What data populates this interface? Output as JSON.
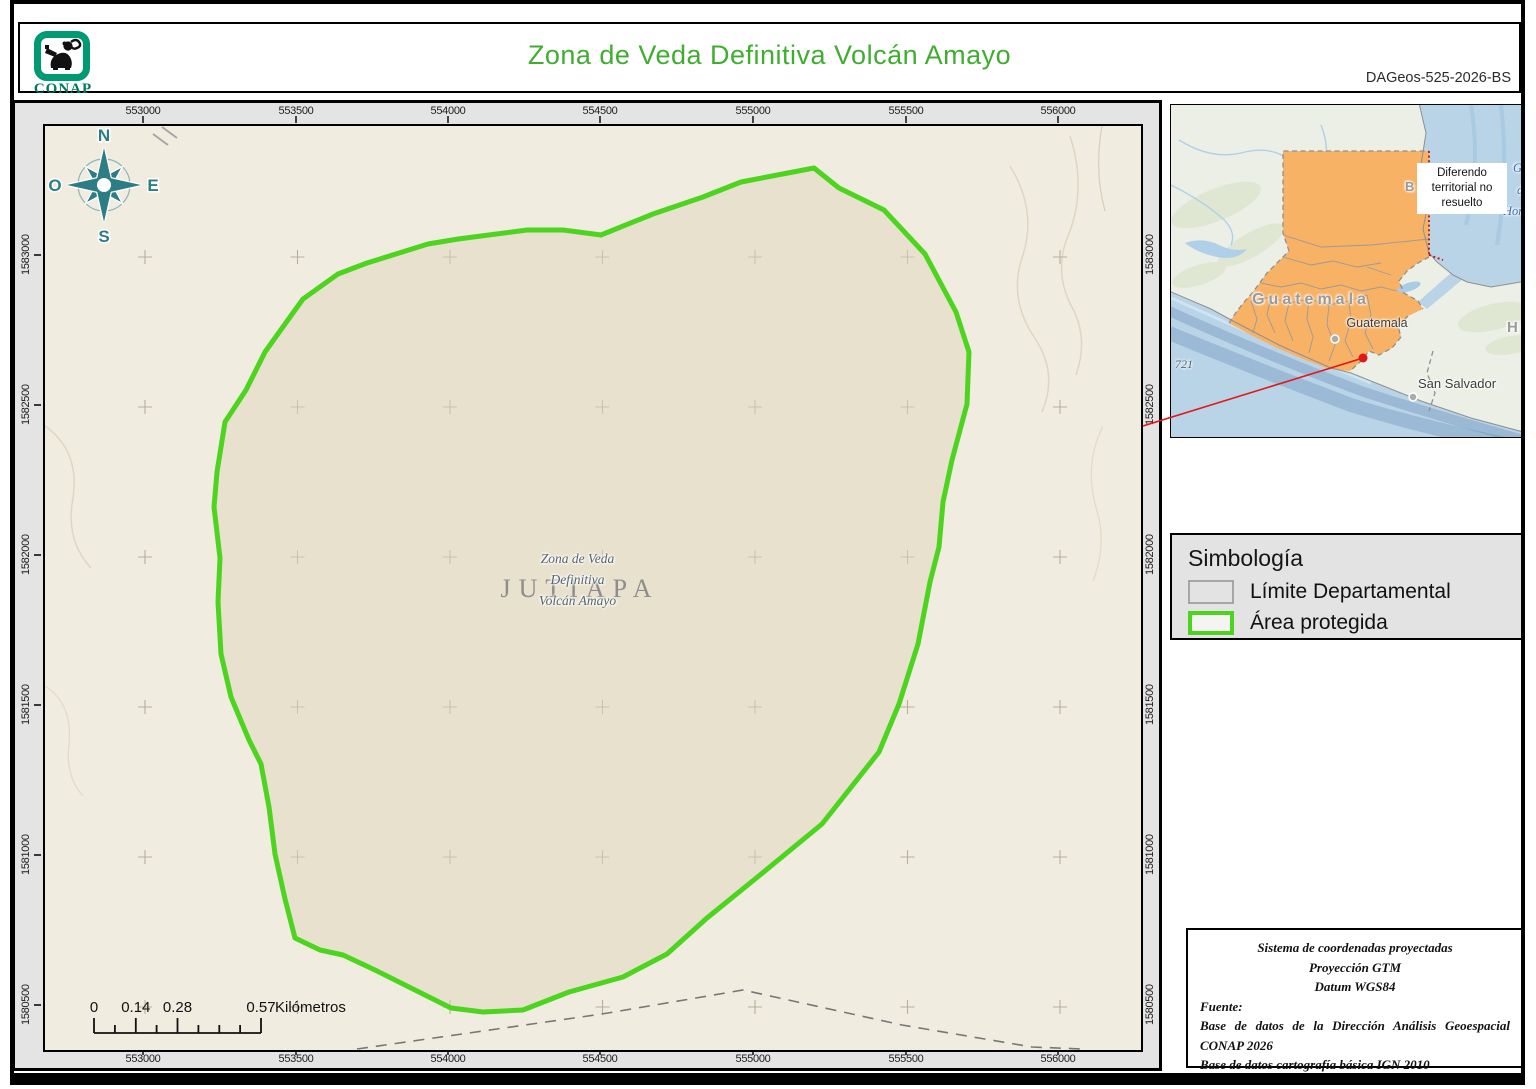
{
  "page": {
    "logo": "CONAP",
    "title": "Zona de Veda Definitiva Volcán Amayo",
    "doc_id": "DAGeos-525-2026-BS"
  },
  "map": {
    "x_ticks": [
      "553000",
      "553500",
      "554000",
      "554500",
      "555000",
      "555500",
      "556000"
    ],
    "y_ticks": [
      "1583000",
      "1582500",
      "1582000",
      "1581500",
      "1581000",
      "1580500"
    ],
    "compass": {
      "n": "N",
      "s": "S",
      "e": "E",
      "o": "O"
    },
    "area_label": {
      "line1": "Zona de Veda",
      "line2": "Definitiva",
      "line3": "Volcán Amayo"
    },
    "department_label": "JUTIAPA",
    "scalebar": {
      "t0": "0",
      "t1": "0.14",
      "t2": "0.28",
      "t3": "0.57",
      "unit": "Kilómetros"
    }
  },
  "inset": {
    "note": "Diferendo territorial no resuelto",
    "country_label": "Guatemala",
    "capital_label": "Guatemala",
    "city_label": "San Salvador",
    "neighbor_fragment": "Hon",
    "belize_fragment": "B",
    "contour_label": "721",
    "sea_fragment_1": "G",
    "sea_fragment_2": "d",
    "sea_fragment_3": "Hond"
  },
  "legend": {
    "title": "Simbología",
    "item1": "Límite Departamental",
    "item2": "Área protegida"
  },
  "source": {
    "l1": "Sistema de coordenadas proyectadas",
    "l2": "Proyección GTM",
    "l3": "Datum WGS84",
    "fuente": "Fuente:",
    "s1": "Base de datos de la Dirección Análisis Geoespacial CONAP 2026",
    "s2": "Base de datos cartografía básica IGN 2010"
  },
  "colors": {
    "title_green": "#3fae2f",
    "protected_area_green": "#4CD41F",
    "compass_teal": "#2d7d85",
    "guatemala_orange": "#F7B266",
    "ocean_blue": "#B9D3E7",
    "locator_red": "#E01818"
  }
}
